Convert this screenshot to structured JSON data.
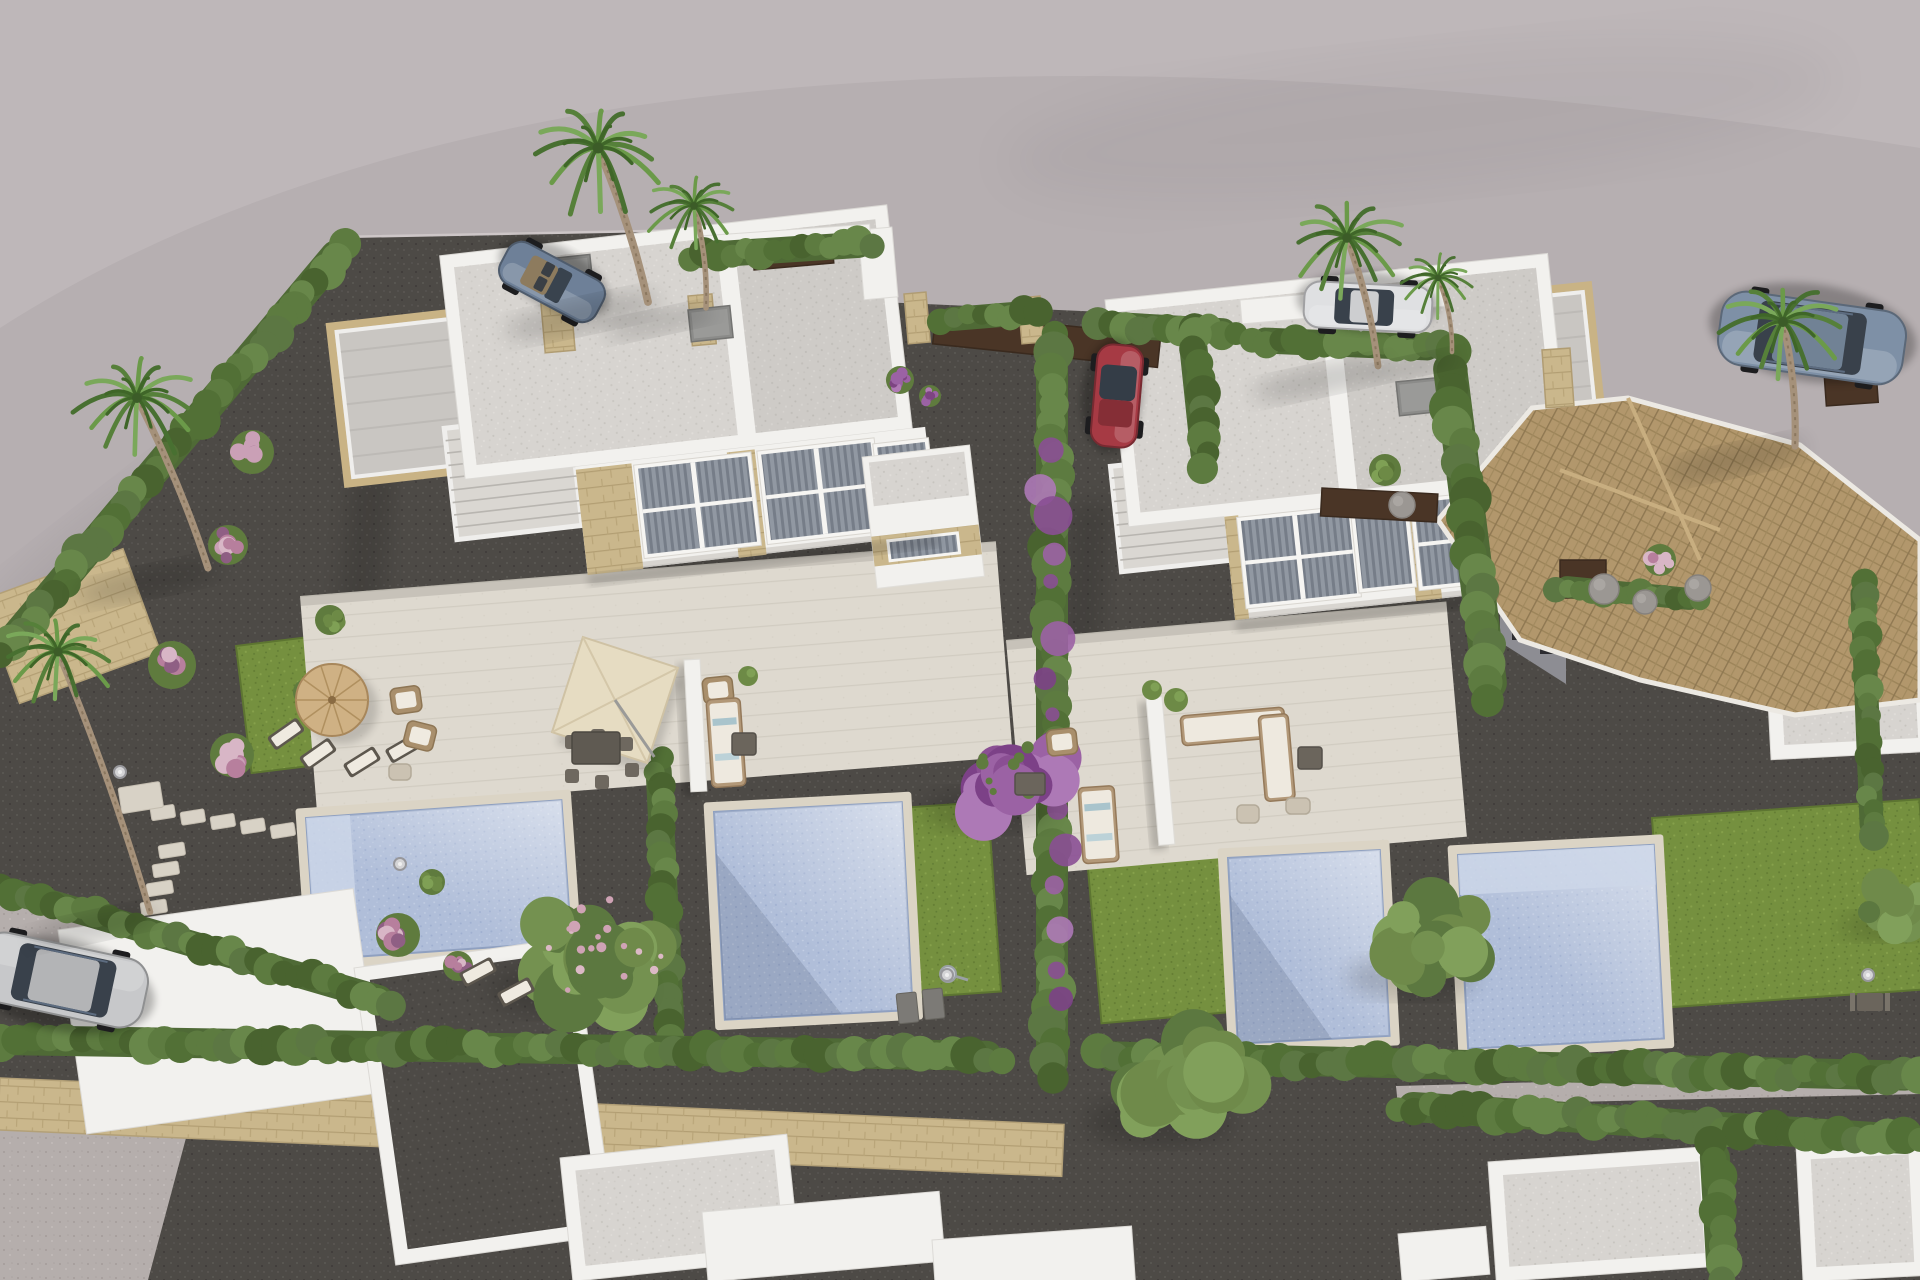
{
  "meta": {
    "title": "Aerial 3D render of new-build white duplex villas with private pools and gardens"
  },
  "palette": {
    "road": "#b6afb1",
    "road_light": "#c5bec0",
    "curb": "#cdc6c7",
    "gravel_dark": "#4d4a46",
    "gravel_light": "#b5aeac",
    "path_light": "#cfc8bb",
    "lawn": "#75903f",
    "hedge": "#54703a",
    "hedge_light": "#68874a",
    "hedge_dark": "#49632f",
    "wall_white": "#f2f1ee",
    "roof_speckle": "#d7d4d0",
    "paving": "#ded9cf",
    "stone": "#c9b385",
    "stone_wall": "#cab78c",
    "pool_water": "#b0bed9",
    "pool_coping": "#dbd4c5",
    "tile_roof": "#b2976c",
    "gate_brown": "#4a3526",
    "flower_pink": "#caa0b6",
    "flower_purple": "#9b62a4",
    "parasol_straw": "#cfb184",
    "parasol_cream": "#e6dcc2",
    "car_blue": "#6e8098",
    "car_red": "#a63a44",
    "car_white": "#dfe0e2",
    "car_suv": "#7e90a6",
    "car_silver": "#c7c8ca",
    "palm_trunk": "#a5917a",
    "palm_frond": "#56803a"
  },
  "ground": {
    "plot_polygon": "0,662 352,238 870,228 880,302 1238,318 1252,336 1448,340 1462,472 1650,502 1920,548 1920,1280 0,1280",
    "road_light_path": "M0,0 H1920 V148 Q1150,28 620,108 Q250,168 0,328 Z",
    "curbs": [
      [
        0,
        668,
        350,
        242
      ],
      [
        352,
        240,
        868,
        230
      ]
    ],
    "light_areas": [
      {
        "name": "driveway-gravel",
        "pts": "0,893 142,922 398,1004 356,1062 0,998"
      },
      {
        "name": "bottom-left-path",
        "pts": "0,1122 186,1138 148,1280 0,1280"
      },
      {
        "name": "hedge-gap-path",
        "pts": "1396,1086 1920,1072 1920,1094 1398,1106"
      }
    ],
    "stone_walls": [
      [
        0,
        1078,
        1065,
        52,
        2.5
      ],
      [
        -18,
        600,
        150,
        110,
        -20
      ]
    ],
    "road_shadows": [
      [
        430,
        860,
        430,
        150,
        -16,
        0.12
      ],
      [
        140,
        600,
        250,
        95,
        -38,
        0.1
      ],
      [
        1420,
        120,
        420,
        70,
        -6,
        0.05
      ]
    ],
    "building_cast_shadows": [
      "352,470 394,468 372,700 330,690",
      "1072,505 1110,502 1094,722 1058,712"
    ]
  },
  "lawns": [
    [
      236,
      646,
      235,
      128,
      -7
    ],
    [
      352,
      952,
      215,
      82,
      -7
    ],
    [
      900,
      808,
      88,
      190,
      -4
    ],
    [
      1086,
      846,
      132,
      178,
      -5
    ],
    [
      1652,
      818,
      268,
      190,
      -4
    ],
    [
      1558,
      556,
      170,
      66,
      -8
    ],
    [
      1740,
      598,
      110,
      48,
      -6
    ]
  ],
  "terraces": [
    [
      300,
      596,
      698,
      216,
      -4.5
    ],
    [
      1006,
      640,
      442,
      236,
      -5
    ]
  ],
  "divider_walls": [
    [
      684,
      660,
      16,
      132,
      -3
    ],
    [
      1146,
      698,
      16,
      148,
      -5
    ]
  ],
  "pools": [
    {
      "x": 306,
      "y": 818,
      "w": 256,
      "h": 142,
      "rot": -4,
      "steps": "left"
    },
    {
      "x": 714,
      "y": 812,
      "w": 188,
      "h": 208,
      "rot": -3,
      "shade": true
    },
    {
      "x": 1228,
      "y": 858,
      "w": 152,
      "h": 186,
      "rot": -3,
      "shade": true
    },
    {
      "x": 1458,
      "y": 855,
      "w": 196,
      "h": 194,
      "rot": -3,
      "steps": "top"
    }
  ],
  "stepping_stones": [
    {
      "x": 150,
      "y": 808,
      "dx": 30,
      "dy": 4.5,
      "n": 7,
      "w": 24,
      "h": 13,
      "rot": -9
    },
    {
      "x": 158,
      "y": 846,
      "dx": -6,
      "dy": 19,
      "n": 5,
      "w": 26,
      "h": 13,
      "rot": -9
    },
    {
      "x": 118,
      "y": 788,
      "dx": 0,
      "dy": 0,
      "n": 1,
      "w": 42,
      "h": 26,
      "rot": -9
    }
  ],
  "duplexes": [
    {
      "name": "left-duplex",
      "x": 385,
      "y": 262,
      "rot": -6.5,
      "roof": [
        55,
        0,
        450,
        225
      ],
      "div": 340,
      "rear": [
        -62,
        58,
        212,
        158
      ],
      "stair": [
        40,
        172,
        126,
        112
      ],
      "wall": [
        166,
        225,
        352,
        108
      ],
      "windows": [
        [
          228,
          234,
          110,
          86,
          "big"
        ],
        [
          352,
          234,
          110,
          86,
          "big"
        ],
        [
          468,
          240,
          48,
          76,
          "small"
        ]
      ],
      "stones": [
        [
          166,
          228,
          56,
          106
        ],
        [
          318,
          228,
          28,
          106
        ]
      ],
      "porch": [
        452,
        248,
        108,
        132
      ]
    },
    {
      "name": "right-duplex",
      "x": 1105,
      "y": 300,
      "rot": -6,
      "roof": [
        0,
        0,
        445,
        228
      ],
      "div": 222,
      "rear": [
        306,
        36,
        176,
        150
      ],
      "stair": [
        -12,
        166,
        118,
        106
      ],
      "wall": [
        96,
        226,
        366,
        106
      ],
      "windows": [
        [
          112,
          234,
          108,
          84,
          "big"
        ],
        [
          226,
          240,
          50,
          74,
          "small"
        ],
        [
          286,
          234,
          108,
          84,
          "big"
        ],
        [
          400,
          240,
          50,
          74,
          "small"
        ]
      ],
      "stones": [
        [
          96,
          228,
          14,
          104
        ],
        [
          278,
          228,
          26,
          104
        ]
      ],
      "porch": null
    }
  ],
  "bottom_roofs": [
    [
      58,
      930,
      298,
      206,
      -8,
      "plain"
    ],
    [
      354,
      968,
      222,
      300,
      -8,
      "court"
    ],
    [
      560,
      1158,
      228,
      124,
      -6,
      "speck"
    ],
    [
      702,
      1212,
      238,
      70,
      -5,
      "plain"
    ],
    [
      932,
      1240,
      200,
      60,
      -4,
      "plain"
    ],
    [
      1488,
      1162,
      224,
      120,
      -4,
      "speck"
    ],
    [
      1796,
      1146,
      126,
      136,
      -3,
      "speck"
    ],
    [
      1398,
      1234,
      88,
      48,
      -5,
      "plain"
    ],
    [
      1760,
      548,
      162,
      212,
      -3,
      "speck"
    ]
  ],
  "tile_house": {
    "roof_pts": "1438,520 1532,408 1628,398 1800,445 1920,540 1920,700 1795,715 1640,680 1520,640",
    "ridges": [
      [
        1560,
        470,
        1720,
        530
      ],
      [
        1628,
        398,
        1700,
        560
      ]
    ],
    "wall_pts": "1500,560 1566,600 1566,684 1500,642",
    "windows": [
      [
        1512,
        602,
        16,
        38
      ],
      [
        1540,
        616,
        16,
        38
      ]
    ]
  },
  "hedges": [
    [
      345,
      244,
      0,
      655,
      30
    ],
    [
      690,
      256,
      872,
      244,
      26
    ],
    [
      940,
      320,
      1038,
      312,
      24
    ],
    [
      1098,
      324,
      1236,
      332,
      26
    ],
    [
      1252,
      340,
      1440,
      348,
      26
    ],
    [
      1448,
      352,
      1492,
      700,
      34
    ],
    [
      1052,
      334,
      1052,
      1078,
      32
    ],
    [
      1192,
      334,
      1206,
      468,
      28
    ],
    [
      658,
      758,
      672,
      1038,
      26
    ],
    [
      0,
      1040,
      1002,
      1056,
      30
    ],
    [
      1098,
      1056,
      1920,
      1076,
      30
    ],
    [
      1398,
      1106,
      1920,
      1140,
      30
    ],
    [
      1714,
      1142,
      1722,
      1280,
      30
    ],
    [
      0,
      888,
      392,
      1002,
      26
    ],
    [
      1862,
      582,
      1872,
      836,
      24
    ],
    [
      1556,
      586,
      1700,
      600,
      22
    ]
  ],
  "bougainvillea_line": [
    1048,
    445,
    1062,
    1000
  ],
  "gates": [
    [
      752,
      246,
      80,
      24,
      -5
    ],
    [
      936,
      312,
      226,
      32,
      6
    ],
    [
      1322,
      488,
      116,
      28,
      3
    ],
    [
      1560,
      560,
      46,
      38,
      0
    ],
    [
      1824,
      372,
      52,
      34,
      -4
    ]
  ],
  "white_walls": [
    [
      858,
      230,
      34,
      70,
      -5
    ],
    [
      700,
      236,
      170,
      16,
      -4
    ],
    [
      1240,
      300,
      204,
      24,
      -5
    ]
  ],
  "pillars": [
    [
      540,
      293,
      30,
      60,
      -5
    ],
    [
      688,
      296,
      24,
      50,
      -5
    ],
    [
      904,
      294,
      22,
      50,
      -5
    ],
    [
      1018,
      298,
      22,
      46,
      -5
    ],
    [
      1542,
      350,
      28,
      58,
      -4
    ]
  ],
  "chimneys": [
    [
      688,
      310,
      42,
      32,
      -6
    ],
    [
      1396,
      382,
      44,
      34,
      -6
    ],
    [
      556,
      258,
      34,
      26,
      -6
    ]
  ],
  "palms": [
    [
      598,
      148,
      1.2,
      648,
      302
    ],
    [
      694,
      206,
      0.85,
      706,
      308
    ],
    [
      137,
      398,
      1.1,
      208,
      568
    ],
    [
      58,
      652,
      1.0,
      150,
      912
    ],
    [
      1347,
      238,
      1.05,
      1378,
      366
    ],
    [
      1438,
      278,
      0.7,
      1452,
      352
    ],
    [
      1783,
      322,
      1.1,
      1795,
      446
    ]
  ],
  "trees": [
    [
      600,
      950,
      88,
      "blossom"
    ],
    [
      1438,
      945,
      72,
      "green"
    ],
    [
      1188,
      1085,
      82,
      "green"
    ],
    [
      1900,
      905,
      48,
      "green"
    ],
    [
      1012,
      778,
      72,
      "purple"
    ]
  ],
  "bushes": [
    [
      252,
      452,
      22,
      "pink"
    ],
    [
      228,
      545,
      20,
      "pink"
    ],
    [
      172,
      665,
      24,
      "pink"
    ],
    [
      232,
      755,
      22,
      "pink"
    ],
    [
      398,
      935,
      22,
      "pink"
    ],
    [
      458,
      966,
      15,
      "pink"
    ],
    [
      330,
      620,
      15,
      "green"
    ],
    [
      306,
      692,
      13,
      "purple"
    ],
    [
      432,
      882,
      13,
      "green"
    ],
    [
      900,
      380,
      14,
      "purple"
    ],
    [
      930,
      396,
      11,
      "purple"
    ],
    [
      1385,
      470,
      16,
      "green"
    ],
    [
      1660,
      560,
      16,
      "pink"
    ],
    [
      1604,
      589,
      15,
      "rock"
    ],
    [
      1645,
      602,
      12,
      "rock"
    ],
    [
      1402,
      505,
      13,
      "rock"
    ],
    [
      1698,
      588,
      13,
      "rock"
    ]
  ],
  "cars": [
    {
      "id": "roadster",
      "x": 552,
      "y": 282,
      "rot": 208,
      "len": 108,
      "wid": 46,
      "color": "#6e8098",
      "type": "convertible"
    },
    {
      "id": "hatchback",
      "x": 1117,
      "y": 396,
      "rot": 95,
      "len": 102,
      "wid": 46,
      "color": "#a63a44",
      "type": "hatch"
    },
    {
      "id": "sedan",
      "x": 1368,
      "y": 307,
      "rot": 183,
      "len": 128,
      "wid": 46,
      "color": "#dfe0e2",
      "type": "sedan"
    },
    {
      "id": "suv",
      "x": 1812,
      "y": 338,
      "rot": 188,
      "len": 186,
      "wid": 74,
      "color": "#7e90a6",
      "type": "suv"
    },
    {
      "id": "compact",
      "x": 62,
      "y": 980,
      "rot": 12,
      "len": 170,
      "wid": 70,
      "color": "#c7c8ca",
      "type": "suv"
    }
  ],
  "furniture": {
    "parasol_round": [
      332,
      700,
      36
    ],
    "parasol_square": [
      615,
      700,
      100,
      18
    ],
    "dining_table": [
      596,
      748,
      48,
      32
    ],
    "dining_chairs": [
      [
        572,
        742
      ],
      [
        598,
        736
      ],
      [
        626,
        744
      ],
      [
        632,
        770
      ],
      [
        602,
        782
      ],
      [
        572,
        776
      ]
    ],
    "loungers": [
      [
        286,
        734,
        -35
      ],
      [
        318,
        754,
        -35
      ],
      [
        362,
        762,
        -32
      ],
      [
        404,
        748,
        -30
      ],
      [
        478,
        972,
        -28
      ],
      [
        516,
        992,
        -28
      ]
    ],
    "armchairs": [
      [
        406,
        700,
        -8
      ],
      [
        420,
        736,
        14
      ],
      [
        718,
        690,
        -6
      ],
      [
        1062,
        742,
        -6
      ]
    ],
    "sofas": [
      [
        706,
        700,
        34,
        88,
        -4
      ],
      [
        1078,
        788,
        36,
        76,
        -4
      ]
    ],
    "corner_sofa": [
      [
        1180,
        716,
        104,
        30,
        -5
      ],
      [
        1258,
        716,
        30,
        86,
        -5
      ]
    ],
    "dark_tables": [
      [
        744,
        744,
        24,
        22
      ],
      [
        1030,
        784,
        30,
        22
      ],
      [
        1310,
        758,
        24,
        22
      ]
    ],
    "poufs": [
      [
        400,
        772,
        22,
        16
      ],
      [
        1248,
        814,
        22,
        18
      ],
      [
        1298,
        806,
        24,
        16
      ]
    ],
    "planters": [
      [
        1176,
        700,
        12
      ],
      [
        1152,
        690,
        10
      ],
      [
        748,
        676,
        10
      ]
    ],
    "garden_table": [
      1870,
      1002
    ],
    "mats": [
      [
        896,
        994,
        20,
        30,
        -6
      ],
      [
        922,
        990,
        20,
        30,
        -6
      ]
    ],
    "shower": [
      948,
      974
    ],
    "lamps": [
      [
        120,
        772
      ],
      [
        400,
        864
      ],
      [
        947,
        975
      ],
      [
        1868,
        975
      ]
    ]
  }
}
